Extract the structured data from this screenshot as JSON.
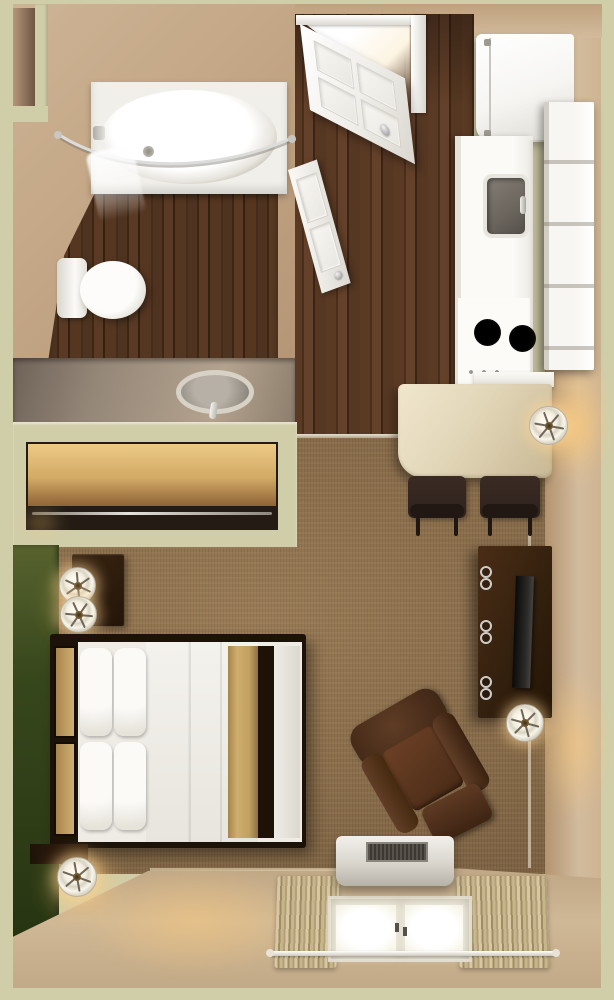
{
  "scene": {
    "title": "Studio apartment — 3D top-down floor plan render",
    "type": "3d-floorplan",
    "width_px": 614,
    "height_px": 1000
  },
  "palette": {
    "wall_top_green": "#d0cda9",
    "wall_face_tan": "#c4a888",
    "accent_wall_green": "#36461b",
    "carpet_brown": "#8a6c49",
    "wood_floor_dark": "#4e3320",
    "counter_cream": "#e3d6b8",
    "furniture_wood_brown": "#3a2413",
    "fixture_white": "#f4f2ec",
    "maple_shelf": "#d2a965",
    "bed_runner_gold": "#c3a161",
    "lamp_glow_warm": "#ffcb7a"
  },
  "rooms": {
    "bathroom": {
      "label": "Bathroom",
      "items": {
        "tub": "Bathtub with shower",
        "rod": "Curved shower curtain rod",
        "curtain": "Shower curtain",
        "toilet": "Toilet",
        "vanity": "Vanity counter with oval sink",
        "floor": "Dark wood floor",
        "niche": "Wall niche"
      }
    },
    "closet": {
      "label": "Closet",
      "items": {
        "shelf": "Wood shelf",
        "rod": "Clothes rod"
      }
    },
    "entry": {
      "label": "Entry hall",
      "items": {
        "entry_door": "Entry door (open)",
        "bathroom_door": "Bathroom door (ajar)",
        "floor": "Wood floor",
        "transition": "Floor transition strip"
      }
    },
    "kitchen": {
      "label": "Kitchenette",
      "items": {
        "fridge": "Refrigerator",
        "sink": "Kitchen sink",
        "stove": "Two-burner cooktop",
        "cabinet": "Tall cabinet unit",
        "counter": "Counter"
      }
    },
    "dining": {
      "label": "Dining nook",
      "items": {
        "table": "Dining table",
        "chair_left": "Dining chair",
        "chair_right": "Dining chair",
        "sconce": "Wall lamp"
      }
    },
    "living": {
      "label": "Living / sleeping area",
      "items": {
        "bed": "Double bed with gold runner",
        "headboard": "Headboard",
        "nightstand": "Nightstand",
        "lamp_1": "Table lamp",
        "lamp_2": "Table lamp",
        "floor_lamp_bed": "Floor lamp at bed corner",
        "desk": "Desk (corner, partially visible)",
        "tv_stand": "TV dresser",
        "tv": "Flat-screen TV",
        "tv_lamp": "Floor lamp at TV stand",
        "armchair": "Recliner armchair",
        "ac": "PTAC air-conditioning unit",
        "window": "Window with curtains",
        "curtain_rod": "Curtain rod",
        "accent_wall": "Green accent wall",
        "carpet": "Carpet"
      }
    }
  }
}
